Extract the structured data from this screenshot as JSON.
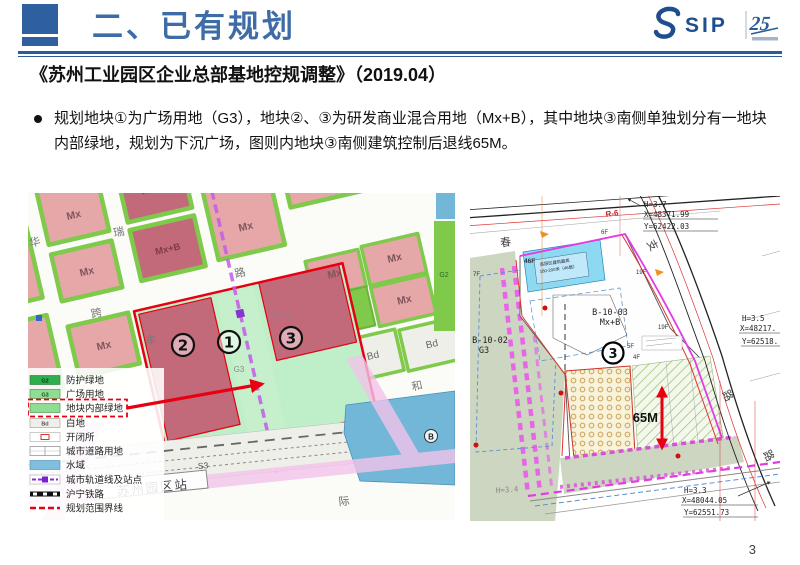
{
  "page": {
    "number": "3"
  },
  "header": {
    "title": "二、已有规划",
    "logo": {
      "sip": "SIP",
      "anniversary": "25"
    },
    "accent_color": "#2E5F9E"
  },
  "doc_title": "《苏州工业园区企业总部基地控规调整》（2019.04）",
  "bullet_text": "规划地块①为广场用地（G3），地块②、③为研发商业混合用地（Mx+B），其中地块③南侧单独划分有一地块内部绿地，规划为下沉广场，图则内地块③南侧建筑控制后退线65M。",
  "left_map": {
    "legend": [
      {
        "code": "G2",
        "label": "防护绿地"
      },
      {
        "code": "G3",
        "label": "广场用地"
      },
      {
        "code": "",
        "label": "地块内部绿地"
      },
      {
        "code": "Bd",
        "label": "白地"
      },
      {
        "code": "",
        "label": "开闭所"
      },
      {
        "code": "",
        "label": "城市道路用地"
      },
      {
        "code": "",
        "label": "水域"
      },
      {
        "code": "",
        "label": "城市轨道线及站点"
      },
      {
        "code": "",
        "label": "沪宁铁路"
      },
      {
        "code": "",
        "label": "规划范围界线"
      }
    ],
    "labels": {
      "mx": "Mx",
      "mxb": "Mx+B",
      "bd": "Bd",
      "g3": "G3",
      "g2": "G2",
      "p1": "1",
      "p2": "2",
      "p3": "3",
      "station": "苏州园区站",
      "station_code": "S3",
      "b_marker": "B",
      "street_hua": "华",
      "street_rui": "瑞",
      "street_kua": "跨",
      "street_feng": "丰",
      "street_lu": "路",
      "street_he": "和",
      "street_ji": "际"
    }
  },
  "right_map": {
    "labels": {
      "parcel_left_code": "B-10-02",
      "parcel_left_use": "G3",
      "parcel_main_code": "B-10-03",
      "parcel_main_use": "Mx+B",
      "plot3": "3",
      "setback": "65M",
      "road_code": "R-6",
      "f46": "46F",
      "f6": "6F",
      "f19a": "19F",
      "f19b": "19F",
      "f5": "5F",
      "f4": "4F",
      "f7": "7F",
      "note_line1": "高层区建筑最高",
      "note_line2": "180-200米（46层）",
      "street_chun": "春",
      "street_zhi": "支",
      "street_lu1": "路",
      "street_lu2": "路",
      "coord1_h": "H=3.7",
      "coord1_x": "X=48371.99",
      "coord1_y": "Y=62422.03",
      "coord2_h": "H=3.5",
      "coord2_x": "X=48217.",
      "coord2_y": "Y=62518.",
      "coord3_h": "H=3.3",
      "coord3_x": "X=48044.05",
      "coord3_y": "Y=62551.73",
      "coord4_h": "H=3.4"
    }
  }
}
